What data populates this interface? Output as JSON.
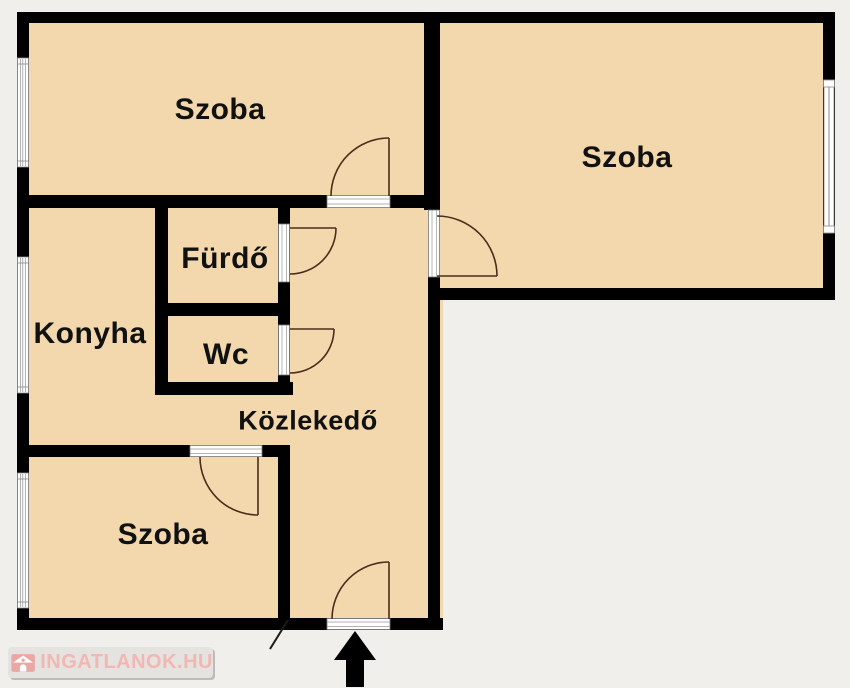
{
  "rooms": [
    {
      "name": "szoba-top-left",
      "label": "Szoba"
    },
    {
      "name": "szoba-top-right",
      "label": "Szoba"
    },
    {
      "name": "furdo",
      "label": "Fürdő"
    },
    {
      "name": "konyha",
      "label": "Konyha"
    },
    {
      "name": "wc",
      "label": "Wc"
    },
    {
      "name": "kozlekedo",
      "label": "Közlekedő"
    },
    {
      "name": "szoba-bottom",
      "label": "Szoba"
    }
  ],
  "watermark": {
    "label": "INGATLANOK.HU",
    "icon": "house-icon"
  },
  "entrance": {
    "icon": "entrance-arrow"
  },
  "colors": {
    "background": "#f0efeb",
    "room_fill": "#f2d8ac",
    "wall": "#000000",
    "door_swing": "#4a2d1c",
    "window_line": "#8a8a8a",
    "label_text": "#111111",
    "watermark_bar": "#e4e3df",
    "watermark_text": "#f3b7b3",
    "watermark_icon": "#e9a8a4"
  }
}
